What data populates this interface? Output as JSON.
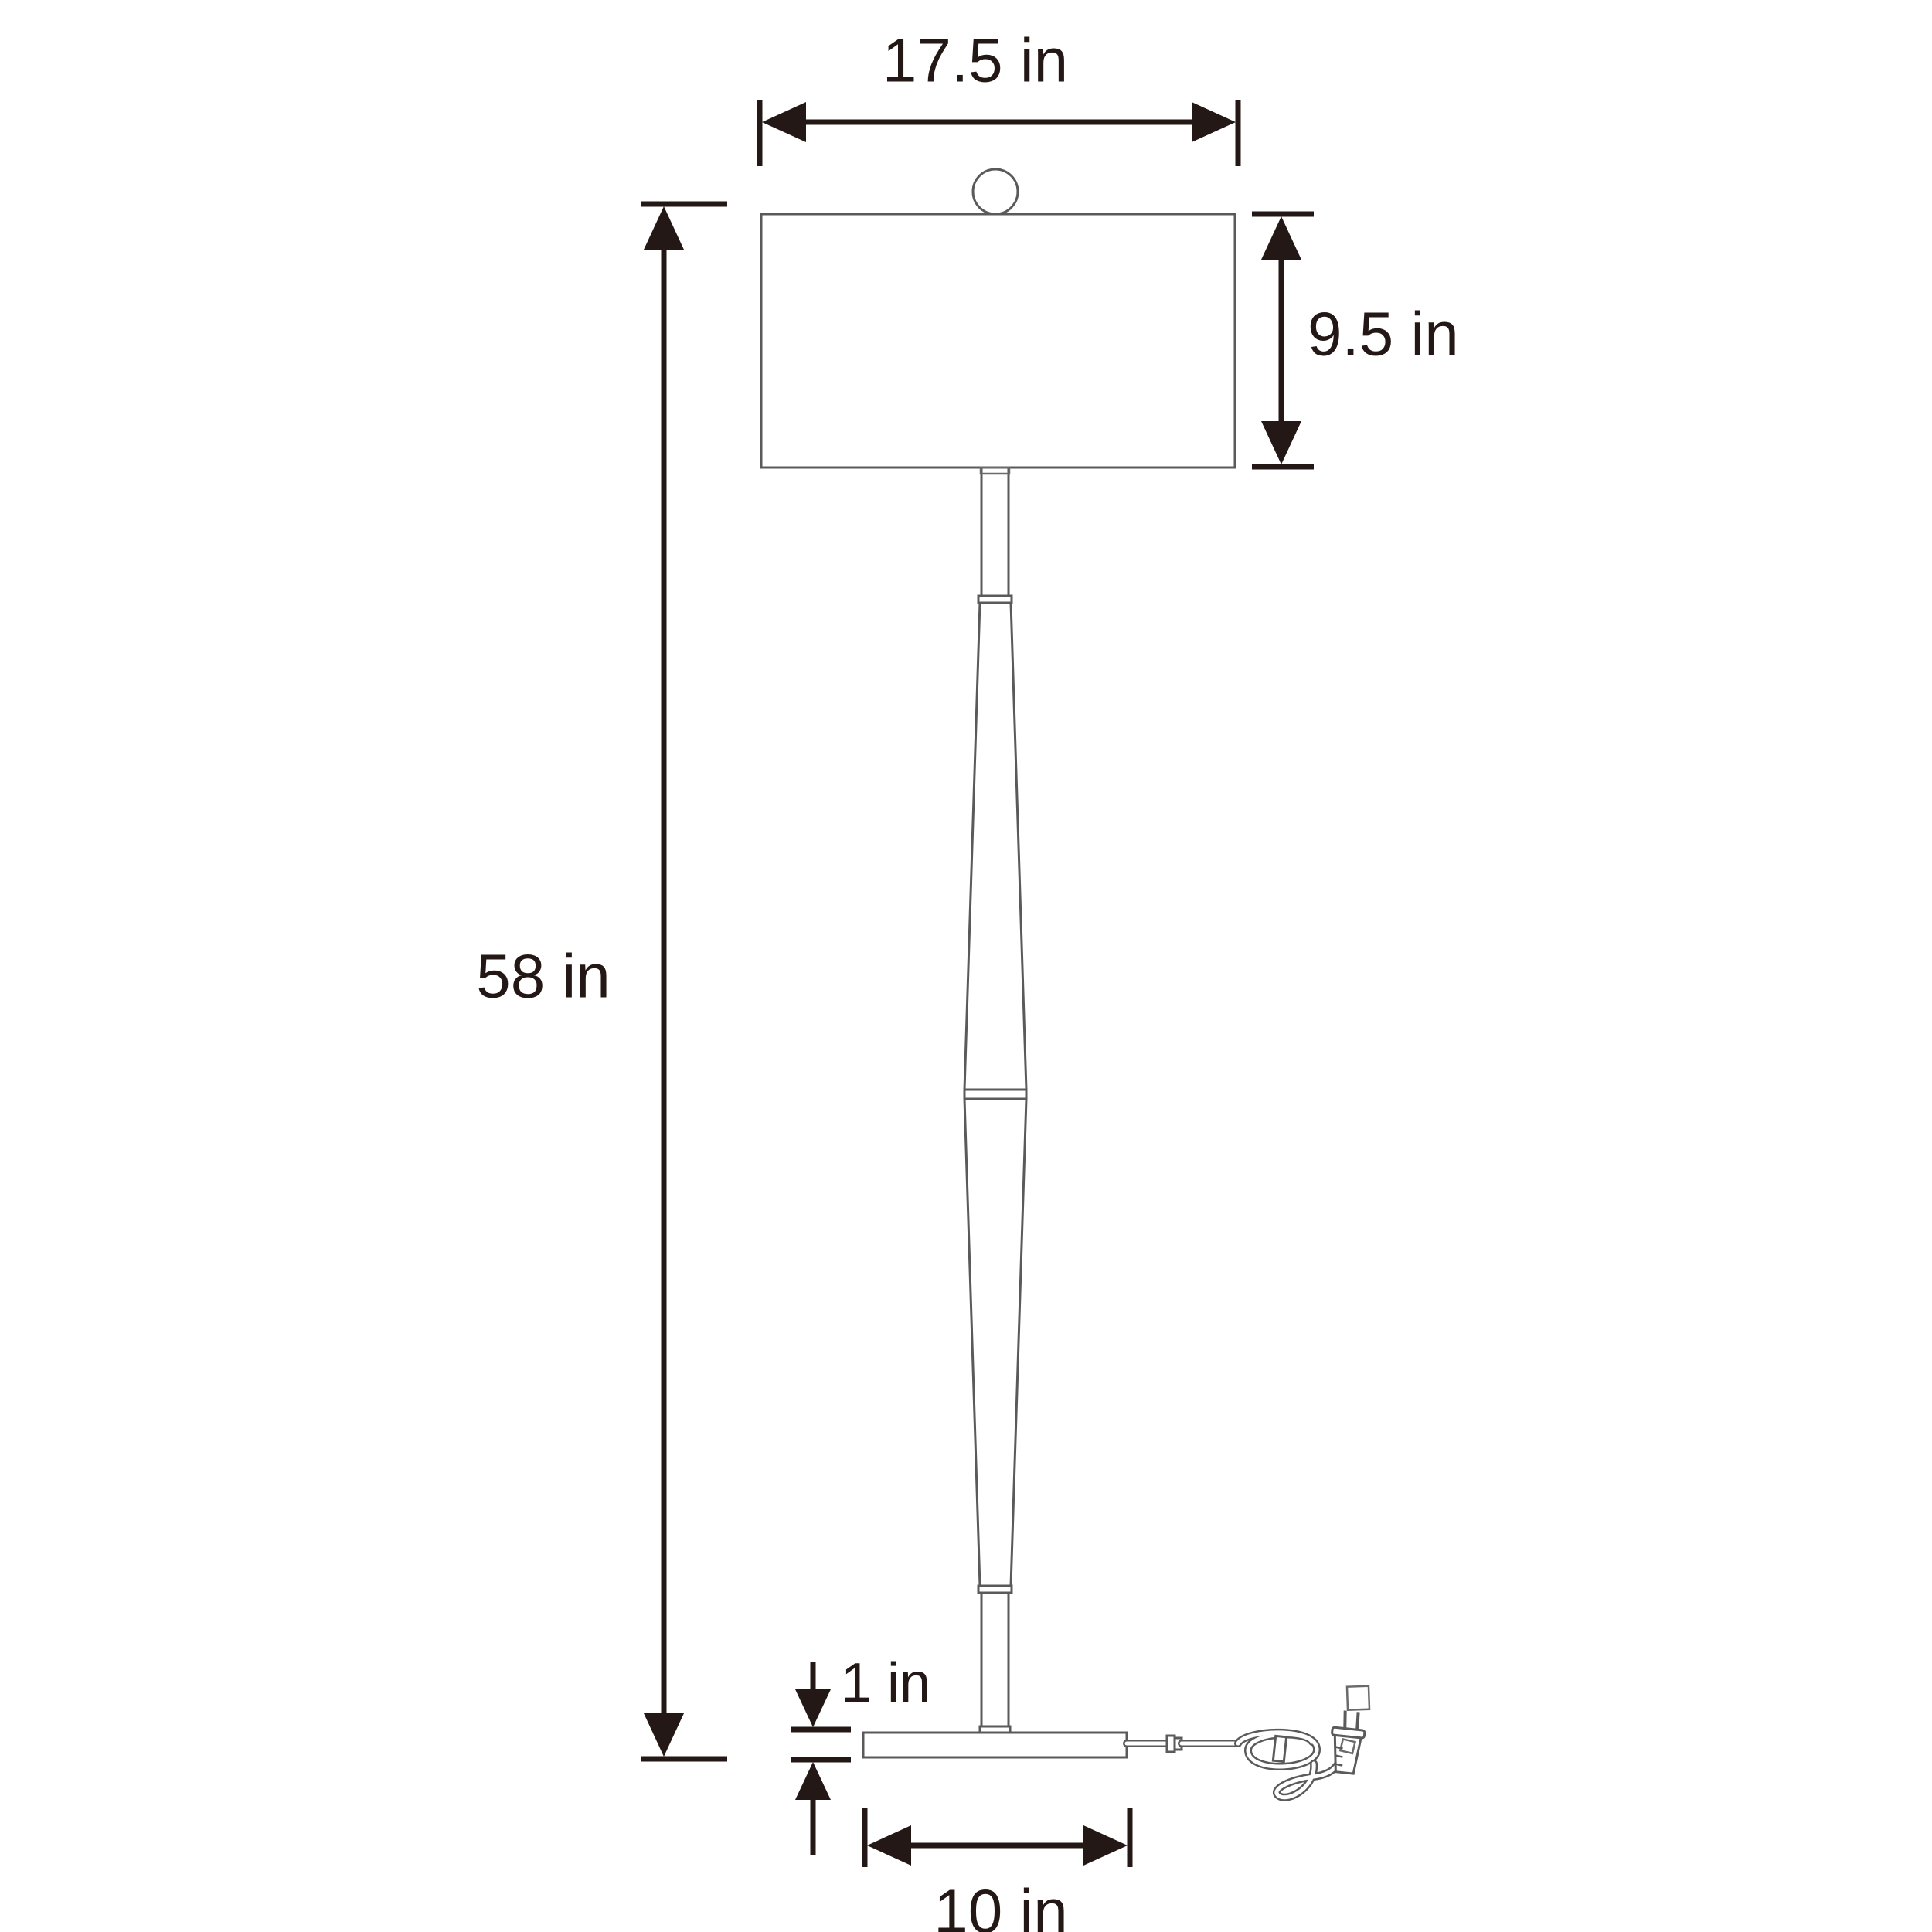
{
  "diagram": {
    "type": "floor-lamp-dimension-drawing",
    "dimensions": {
      "shade_width": "17.5 in",
      "shade_height": "9.5 in",
      "lamp_height": "58 in",
      "base_height": "1 in",
      "base_width": "10 in"
    },
    "colors": {
      "dimension_ink": "#231815",
      "lamp_outline": "#5a5a5a",
      "background": "#ffffff"
    }
  }
}
